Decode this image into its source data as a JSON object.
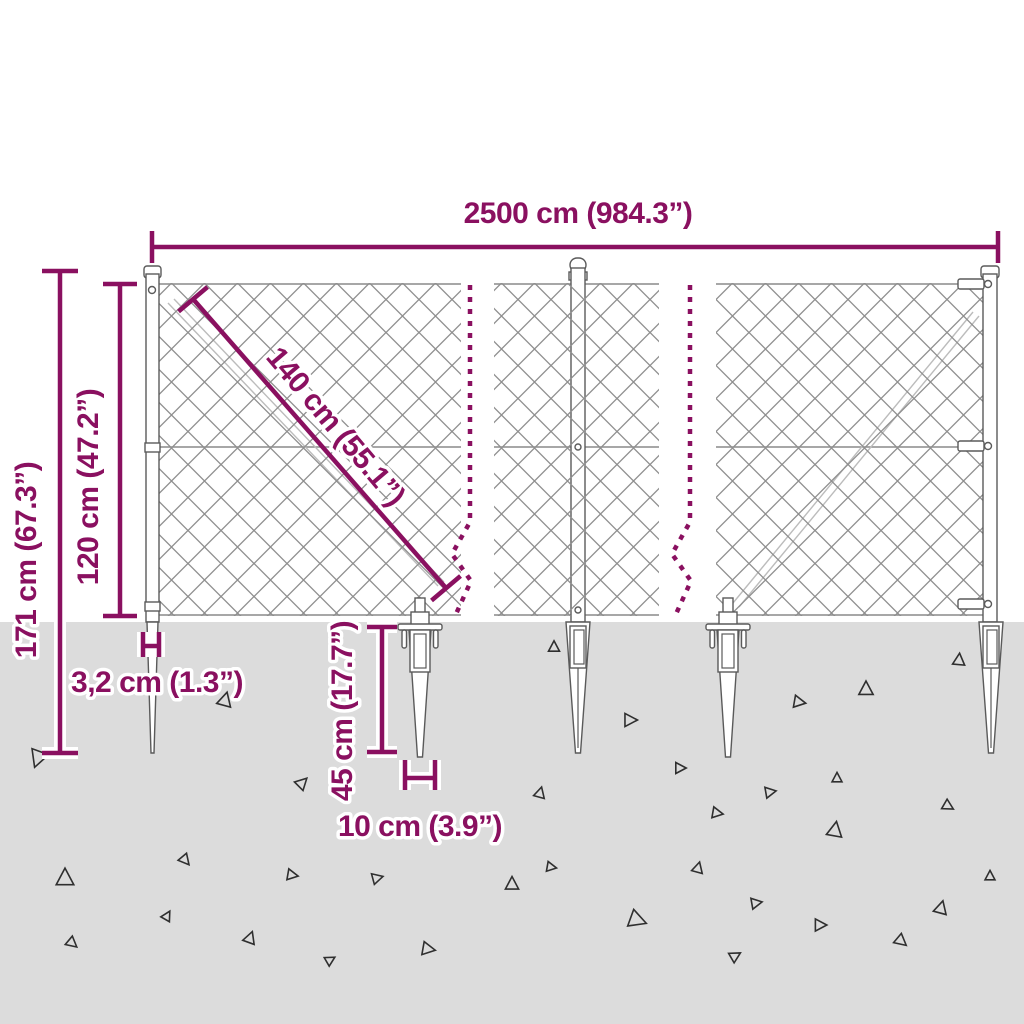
{
  "labels": {
    "total_width": "2500 cm (984.3”)",
    "total_height": "171 cm (67.3”)",
    "fence_height": "120 cm (47.2”)",
    "panel_diagonal": "140 cm (55.1”)",
    "post_diameter": "3,2 cm (1.3”)",
    "anchor_length": "45 cm (17.7”)",
    "anchor_width": "10 cm (3.9”)"
  },
  "colors": {
    "dimension_accent": "#8a1060",
    "ground": "#dcdcdc",
    "mesh_line": "#8f8f8f",
    "structure_line": "#5a5a5a",
    "triangle_line": "#2f2f2f"
  },
  "ground_triangles": [
    {
      "x": 38,
      "y": 758,
      "s": 16,
      "r": 200
    },
    {
      "x": 225,
      "y": 700,
      "s": 13,
      "r": 15
    },
    {
      "x": 554,
      "y": 647,
      "s": 10,
      "r": 0
    },
    {
      "x": 630,
      "y": 720,
      "s": 12,
      "r": 90
    },
    {
      "x": 799,
      "y": 702,
      "s": 11,
      "r": 100
    },
    {
      "x": 866,
      "y": 689,
      "s": 13,
      "r": 0
    },
    {
      "x": 959,
      "y": 660,
      "s": 11,
      "r": 5
    },
    {
      "x": 302,
      "y": 783,
      "s": 11,
      "r": 45
    },
    {
      "x": 680,
      "y": 768,
      "s": 10,
      "r": 90
    },
    {
      "x": 540,
      "y": 793,
      "s": 10,
      "r": 15
    },
    {
      "x": 770,
      "y": 792,
      "s": 10,
      "r": 80
    },
    {
      "x": 837,
      "y": 778,
      "s": 9,
      "r": 0
    },
    {
      "x": 717,
      "y": 813,
      "s": 10,
      "r": 100
    },
    {
      "x": 948,
      "y": 806,
      "s": 10,
      "r": 120
    },
    {
      "x": 835,
      "y": 830,
      "s": 14,
      "r": 10
    },
    {
      "x": 65,
      "y": 878,
      "s": 16,
      "r": 0
    },
    {
      "x": 185,
      "y": 860,
      "s": 10,
      "r": 140
    },
    {
      "x": 292,
      "y": 875,
      "s": 10,
      "r": 100
    },
    {
      "x": 377,
      "y": 878,
      "s": 10,
      "r": 75
    },
    {
      "x": 512,
      "y": 884,
      "s": 12,
      "r": 0
    },
    {
      "x": 551,
      "y": 867,
      "s": 9,
      "r": 100
    },
    {
      "x": 698,
      "y": 868,
      "s": 10,
      "r": 15
    },
    {
      "x": 990,
      "y": 876,
      "s": 9,
      "r": 0
    },
    {
      "x": 167,
      "y": 916,
      "s": 9,
      "r": 30
    },
    {
      "x": 250,
      "y": 938,
      "s": 11,
      "r": 20
    },
    {
      "x": 330,
      "y": 960,
      "s": 9,
      "r": 60
    },
    {
      "x": 428,
      "y": 949,
      "s": 12,
      "r": 100
    },
    {
      "x": 637,
      "y": 920,
      "s": 16,
      "r": 110
    },
    {
      "x": 756,
      "y": 903,
      "s": 10,
      "r": 80
    },
    {
      "x": 820,
      "y": 925,
      "s": 11,
      "r": 90
    },
    {
      "x": 941,
      "y": 908,
      "s": 12,
      "r": 15
    },
    {
      "x": 901,
      "y": 941,
      "s": 11,
      "r": 130
    },
    {
      "x": 72,
      "y": 943,
      "s": 10,
      "r": 130
    },
    {
      "x": 735,
      "y": 956,
      "s": 10,
      "r": 60
    }
  ]
}
